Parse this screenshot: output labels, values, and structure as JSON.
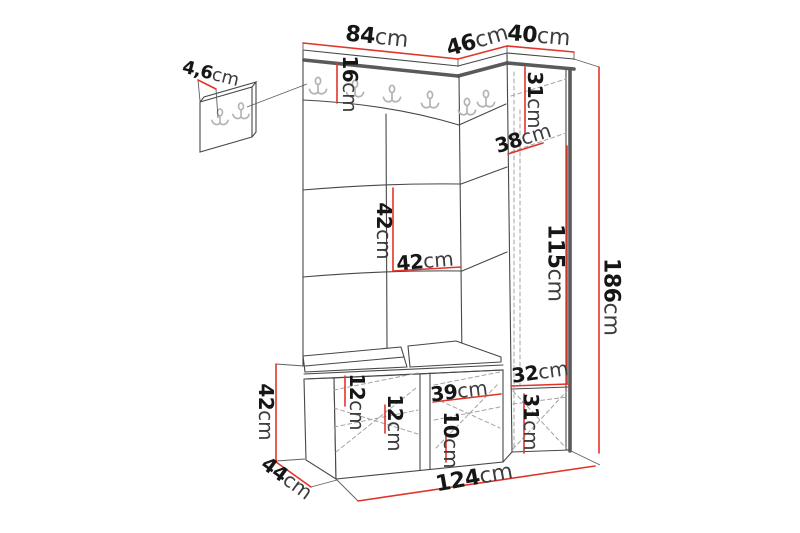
{
  "diagram": {
    "type": "furniture-dimension-drawing",
    "subject": "hallway set: wall hook panel, corner wardrobe with coat hooks and upholstered panels, shoe bench with cushions, tall side cabinet"
  },
  "colors": {
    "dimension_red": "#e23429",
    "outline": "#474747",
    "thick_edge": "#5a5a5a",
    "hidden_dashed": "#a3a3a3",
    "hook_gray": "#b3b3b3",
    "background": "#ffffff"
  },
  "dims": {
    "main_width": {
      "value": "84",
      "unit": "cm"
    },
    "corner_width": {
      "value": "46",
      "unit": "cm"
    },
    "cabinet_width": {
      "value": "40",
      "unit": "cm"
    },
    "wall_panel_depth": {
      "value": "4,6",
      "unit": "cm"
    },
    "hook_rail_height": {
      "value": "16",
      "unit": "cm"
    },
    "cabinet_top_height": {
      "value": "31",
      "unit": "cm"
    },
    "cabinet_shelf_depth": {
      "value": "38",
      "unit": "cm"
    },
    "panel_tile_height": {
      "value": "42",
      "unit": "cm"
    },
    "panel_tile_width": {
      "value": "42",
      "unit": "cm"
    },
    "cabinet_mid_height": {
      "value": "115",
      "unit": "cm"
    },
    "total_height": {
      "value": "186",
      "unit": "cm"
    },
    "bench_height": {
      "value": "42",
      "unit": "cm"
    },
    "bench_depth": {
      "value": "44",
      "unit": "cm"
    },
    "bench_top_thickness": {
      "value": "12",
      "unit": "cm"
    },
    "bench_left_shelf": {
      "value": "12",
      "unit": "cm"
    },
    "bench_right_width": {
      "value": "39",
      "unit": "cm"
    },
    "bench_right_shelf": {
      "value": "10",
      "unit": "cm"
    },
    "cabinet_bottom_width": {
      "value": "32",
      "unit": "cm"
    },
    "cabinet_bottom_height": {
      "value": "31",
      "unit": "cm"
    },
    "total_width": {
      "value": "124",
      "unit": "cm"
    }
  }
}
